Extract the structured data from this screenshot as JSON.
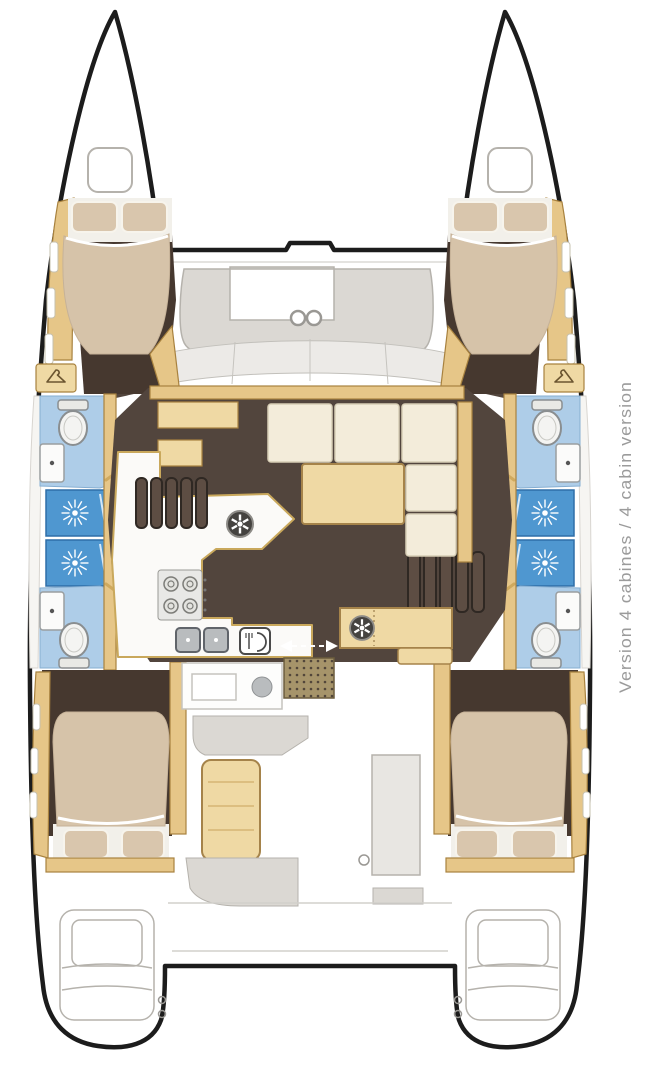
{
  "label": {
    "text": "Version 4 cabines / 4 cabin version"
  },
  "colors": {
    "hull_outline": "#1c1c1c",
    "white": "#ffffff",
    "deck_gray": "#dbd8d3",
    "deck_line": "#b5b2ac",
    "wood": "#e6c688",
    "wood_light": "#efd9a4",
    "wood_edge": "#a8823f",
    "floor_brown": "#52453d",
    "floor_brown_dark": "#46382f",
    "bed_beige": "#d6c3a9",
    "pillow_beige": "#d9c6ad",
    "cushion_cream": "#f3ecda",
    "bath_blue": "#aecde8",
    "shower_blue": "#4f97d0",
    "steel_gray": "#b9bcbe",
    "label_gray": "#9b9b9b"
  },
  "icons": {
    "shower": "shower-sunburst-icon",
    "toilet": "toilet-icon",
    "sink": "sink-icon",
    "double_sink": "double-sink-icon",
    "stove": "stove-burners-icon",
    "fridge": "fridge-cutlery-icon",
    "vent": "fan-hatch-icon",
    "wardrobe": "hanger-icon",
    "deck_hatch": "deck-hatch-icon",
    "door": "sliding-door-arrows-icon"
  }
}
